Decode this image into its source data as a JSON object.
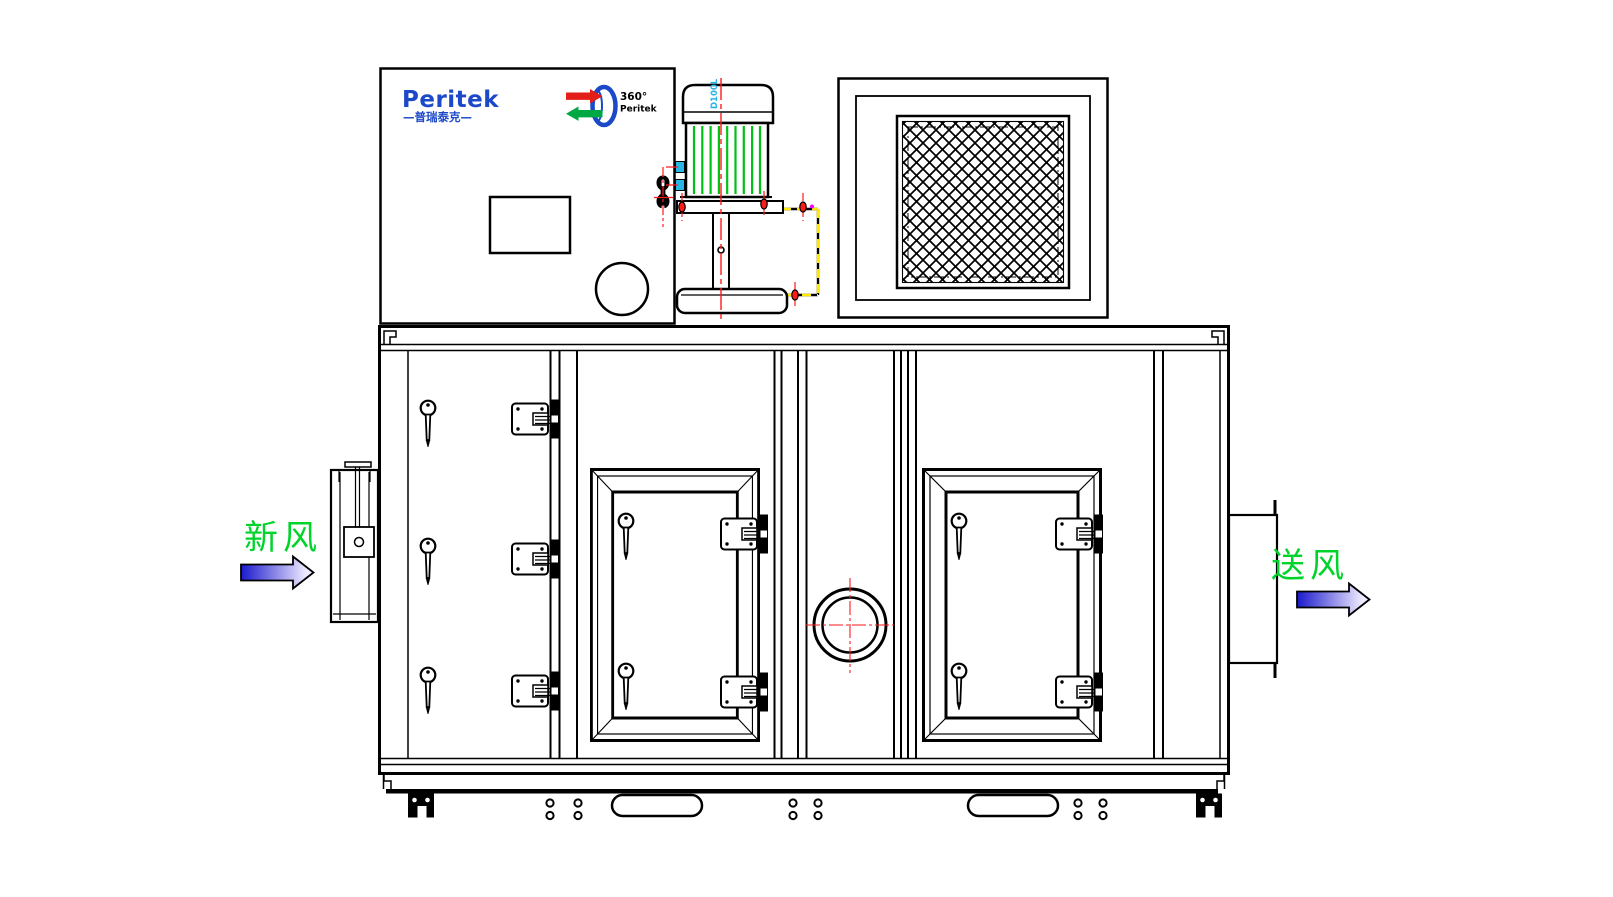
{
  "brand": {
    "name": "Peritek",
    "tagline_cn": "—普瑞泰克—",
    "rotor_degrees": "360°",
    "rotor_name": "Peritek"
  },
  "motor": {
    "frame_size": "D100L"
  },
  "airflow": {
    "inlet_label": "新风",
    "outlet_label": "送风"
  },
  "colors": {
    "line_black": "#000000",
    "brand_blue": "#1c49c8",
    "label_green": "#00d42a",
    "fin_green": "#00c214",
    "centerline_red": "#ff1a1a",
    "hidden_yellow": "#ffe800",
    "accent_cyan": "#29b6e6",
    "magenta_dot": "#ff00ff",
    "rotor_red": "#e31e18",
    "rotor_green": "#00a844",
    "arrow_dark_blue": "#1a1acc",
    "arrow_light": "#efeaff"
  }
}
